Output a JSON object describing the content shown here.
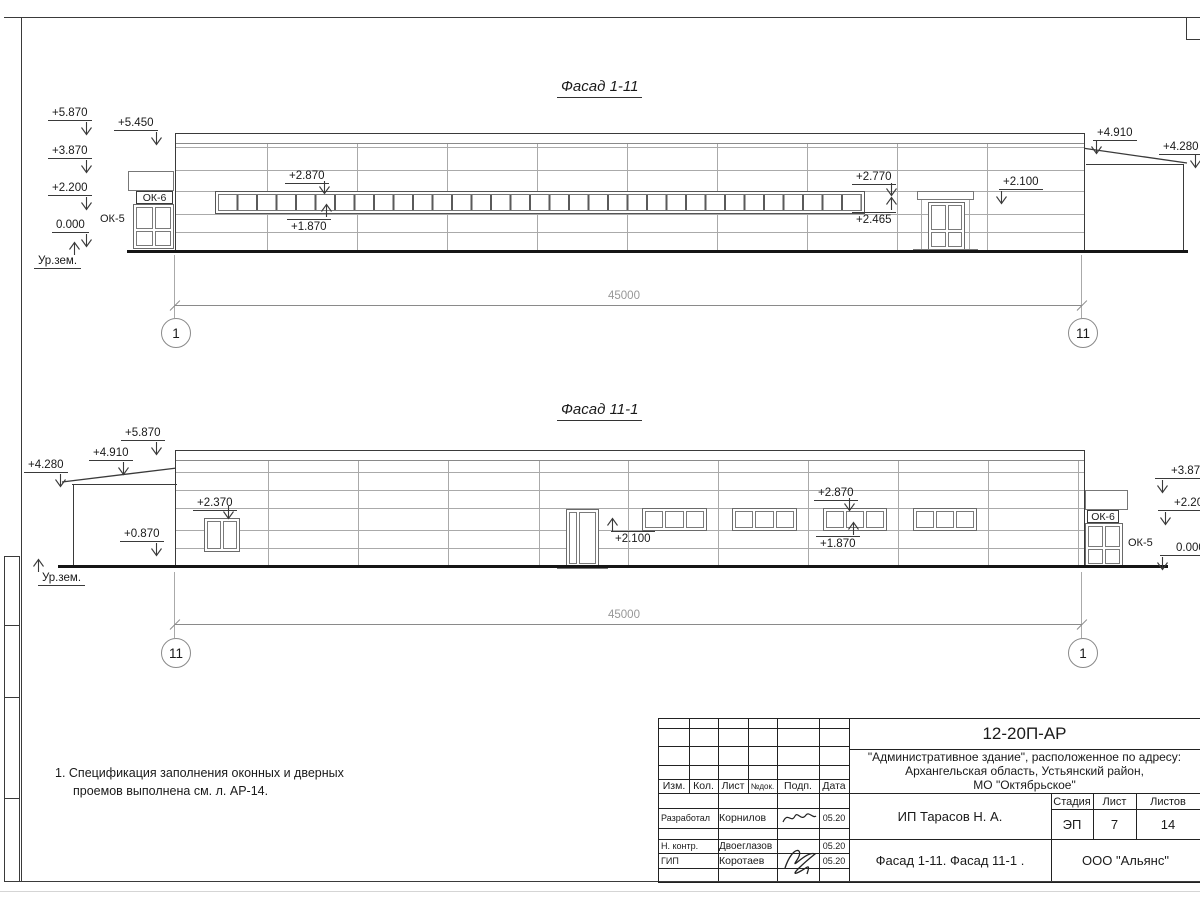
{
  "sheet_frame": {},
  "facade_top": {
    "title": "Фасад 1-11",
    "dim_total": "45000",
    "axis_left": "1",
    "axis_right": "11",
    "ground_label": "Ур.зем.",
    "marks": {
      "m5870": "+5.870",
      "m5450": "+5.450",
      "m3870": "+3.870",
      "m2200": "+2.200",
      "m0000": "0.000",
      "m2870": "+2.870",
      "m1870": "+1.870",
      "m2770": "+2.770",
      "m2465": "+2.465",
      "m2100": "+2.100",
      "m4910": "+4.910",
      "m4280": "+4.280"
    },
    "labels": {
      "ok6": "ОК-6",
      "ok5": "ОК-5"
    }
  },
  "facade_bottom": {
    "title": "Фасад 11-1",
    "dim_total": "45000",
    "axis_left": "11",
    "axis_right": "1",
    "ground_label": "Ур.зем.",
    "marks": {
      "m5870": "+5.870",
      "m4910": "+4.910",
      "m4280": "+4.280",
      "m0870": "+0.870",
      "m2370": "+2.370",
      "m2100": "+2.100",
      "m2870": "+2.870",
      "m1870": "+1.870",
      "m3870": "+3.870",
      "m2200": "+2.200",
      "m0000": "0.000"
    },
    "labels": {
      "ok6": "ОК-6",
      "ok5": "ОК-5"
    }
  },
  "notes": {
    "line1": "1. Спецификация заполнения оконных и дверных",
    "line2": "проемов выполнена см. л. АР-14."
  },
  "title_block": {
    "doc_code": "12-20П-АР",
    "project_line1": "\"Административное здание\", расположенное по адресу:",
    "project_line2": "Архангельская область, Устьянский район,",
    "project_line3": "МО \"Октябрьское\"",
    "header": {
      "izm": "Изм.",
      "kol": "Кол.",
      "list": "Лист",
      "ndok": "№док.",
      "podp": "Подп.",
      "data": "Дата"
    },
    "rows": [
      {
        "role": "Разработал",
        "name": "Корнилов",
        "date": "05.20"
      },
      {
        "role": "Н. контр.",
        "name": "Двоеглазов",
        "date": "05.20"
      },
      {
        "role": "ГИП",
        "name": "Коротаев",
        "date": "05.20"
      }
    ],
    "client": "ИП Тарасов Н. А.",
    "stage_header": {
      "stage": "Стадия",
      "sheet": "Лист",
      "sheets": "Листов"
    },
    "stage_values": {
      "stage": "ЭП",
      "sheet": "7",
      "sheets": "14"
    },
    "sheet_title": "Фасад 1-11. Фасад 11-1 .",
    "org": "ООО \"Альянс\""
  }
}
